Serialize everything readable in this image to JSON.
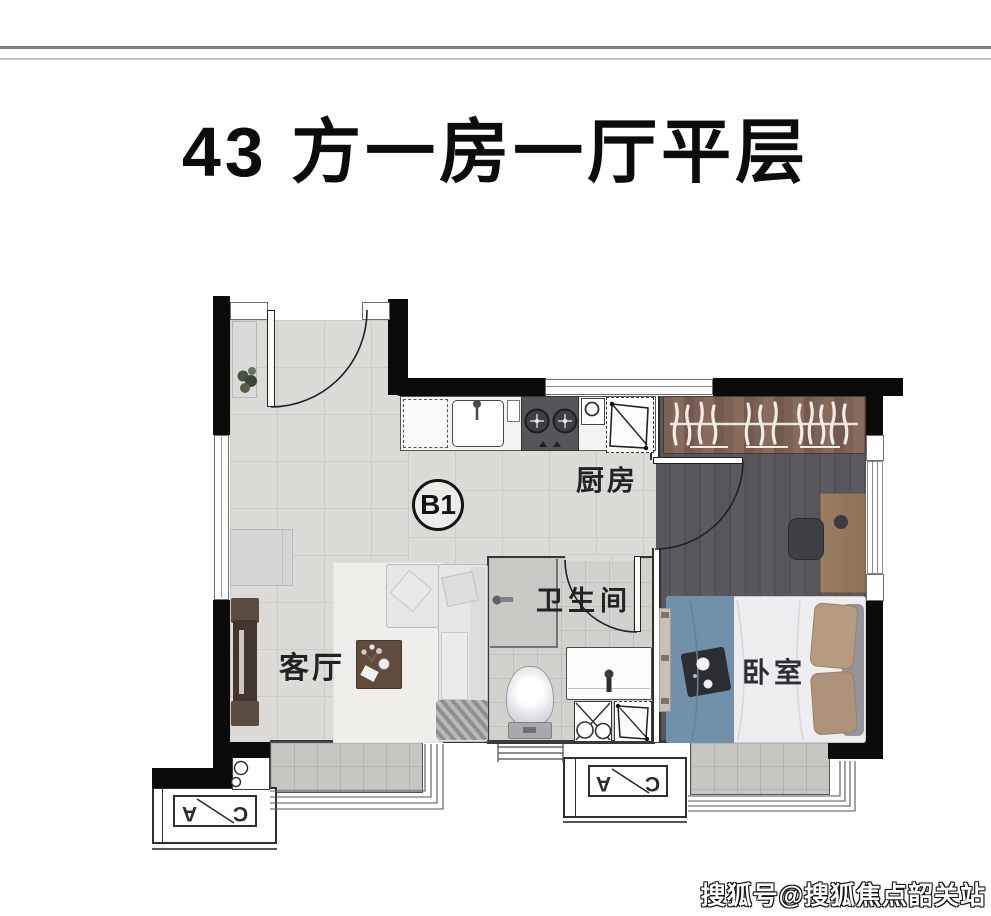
{
  "title": "43 方一房一厅平层",
  "unit_badge": "B1",
  "rooms": {
    "kitchen": "厨房",
    "bathroom": "卫生间",
    "living_room": "客厅",
    "bedroom": "卧室"
  },
  "ac_unit": {
    "letter_a": "A",
    "letter_c": "C"
  },
  "watermark": "搜狐号@搜狐焦点韶关站",
  "colors": {
    "wall": "#0b0b0b",
    "floor_tile": "#dcdbd7",
    "bathroom_tile": "#d2d1cd",
    "bedroom_floor": "#56565c",
    "wardrobe_wood": "#7b6156",
    "bed_blanket_blue": "#7190aa",
    "balcony_tile": "#c7c6c2",
    "title_color": "#0c0c0c"
  }
}
